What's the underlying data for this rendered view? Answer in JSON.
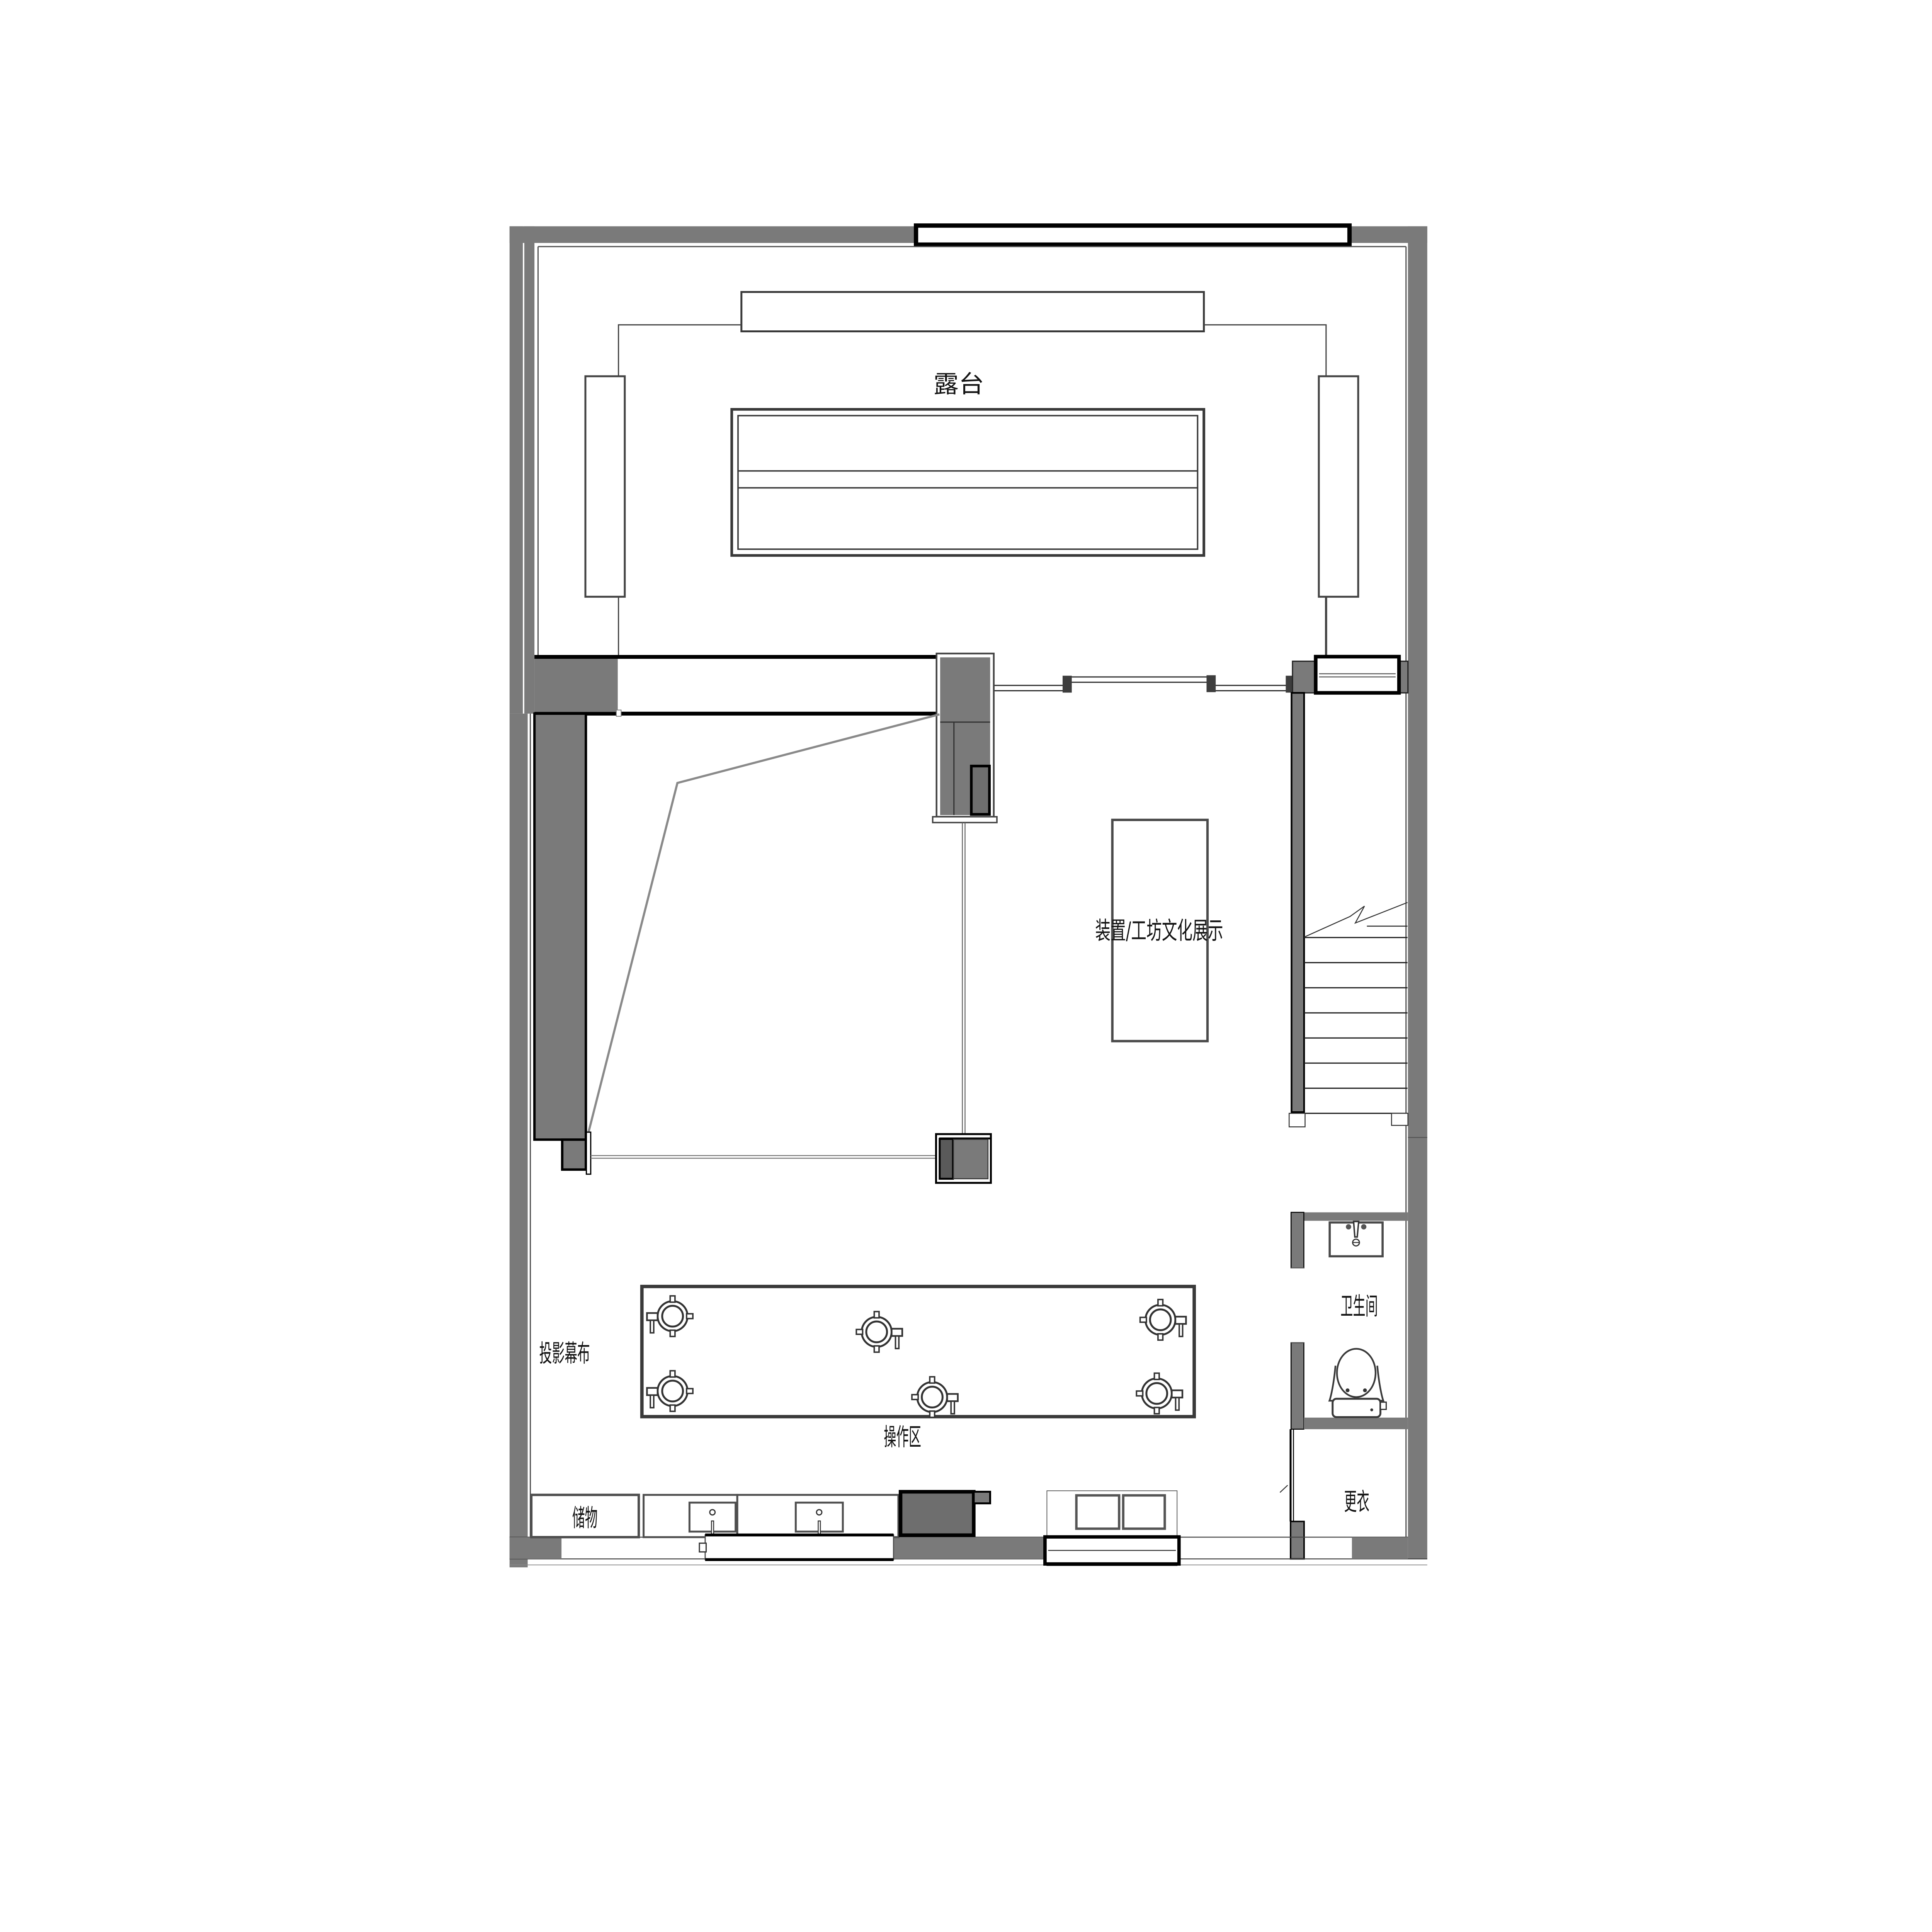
{
  "drawing": {
    "type": "architectural-floor-plan",
    "rooms": {
      "terrace": {
        "label": "露台"
      },
      "exhibition": {
        "label": "装置/工坊文化展示"
      },
      "projection": {
        "label": "投影幕布"
      },
      "operation": {
        "label": "操作区"
      },
      "bathroom": {
        "label": "卫生间"
      },
      "changing": {
        "label": "更衣"
      },
      "storage": {
        "label": "储物"
      }
    },
    "colors": {
      "wall_gray": "#7a7a7a",
      "dark_unit_gray": "#6e6e6e",
      "outline_black": "#000000",
      "line_dark": "#3a3a3a",
      "line_mid": "#555555",
      "cone_gray": "#8a8a8a",
      "paper": "#ffffff",
      "text": "#141414"
    },
    "counts": {
      "stools": 6,
      "stair_treads": 8,
      "sinks": 2
    }
  }
}
